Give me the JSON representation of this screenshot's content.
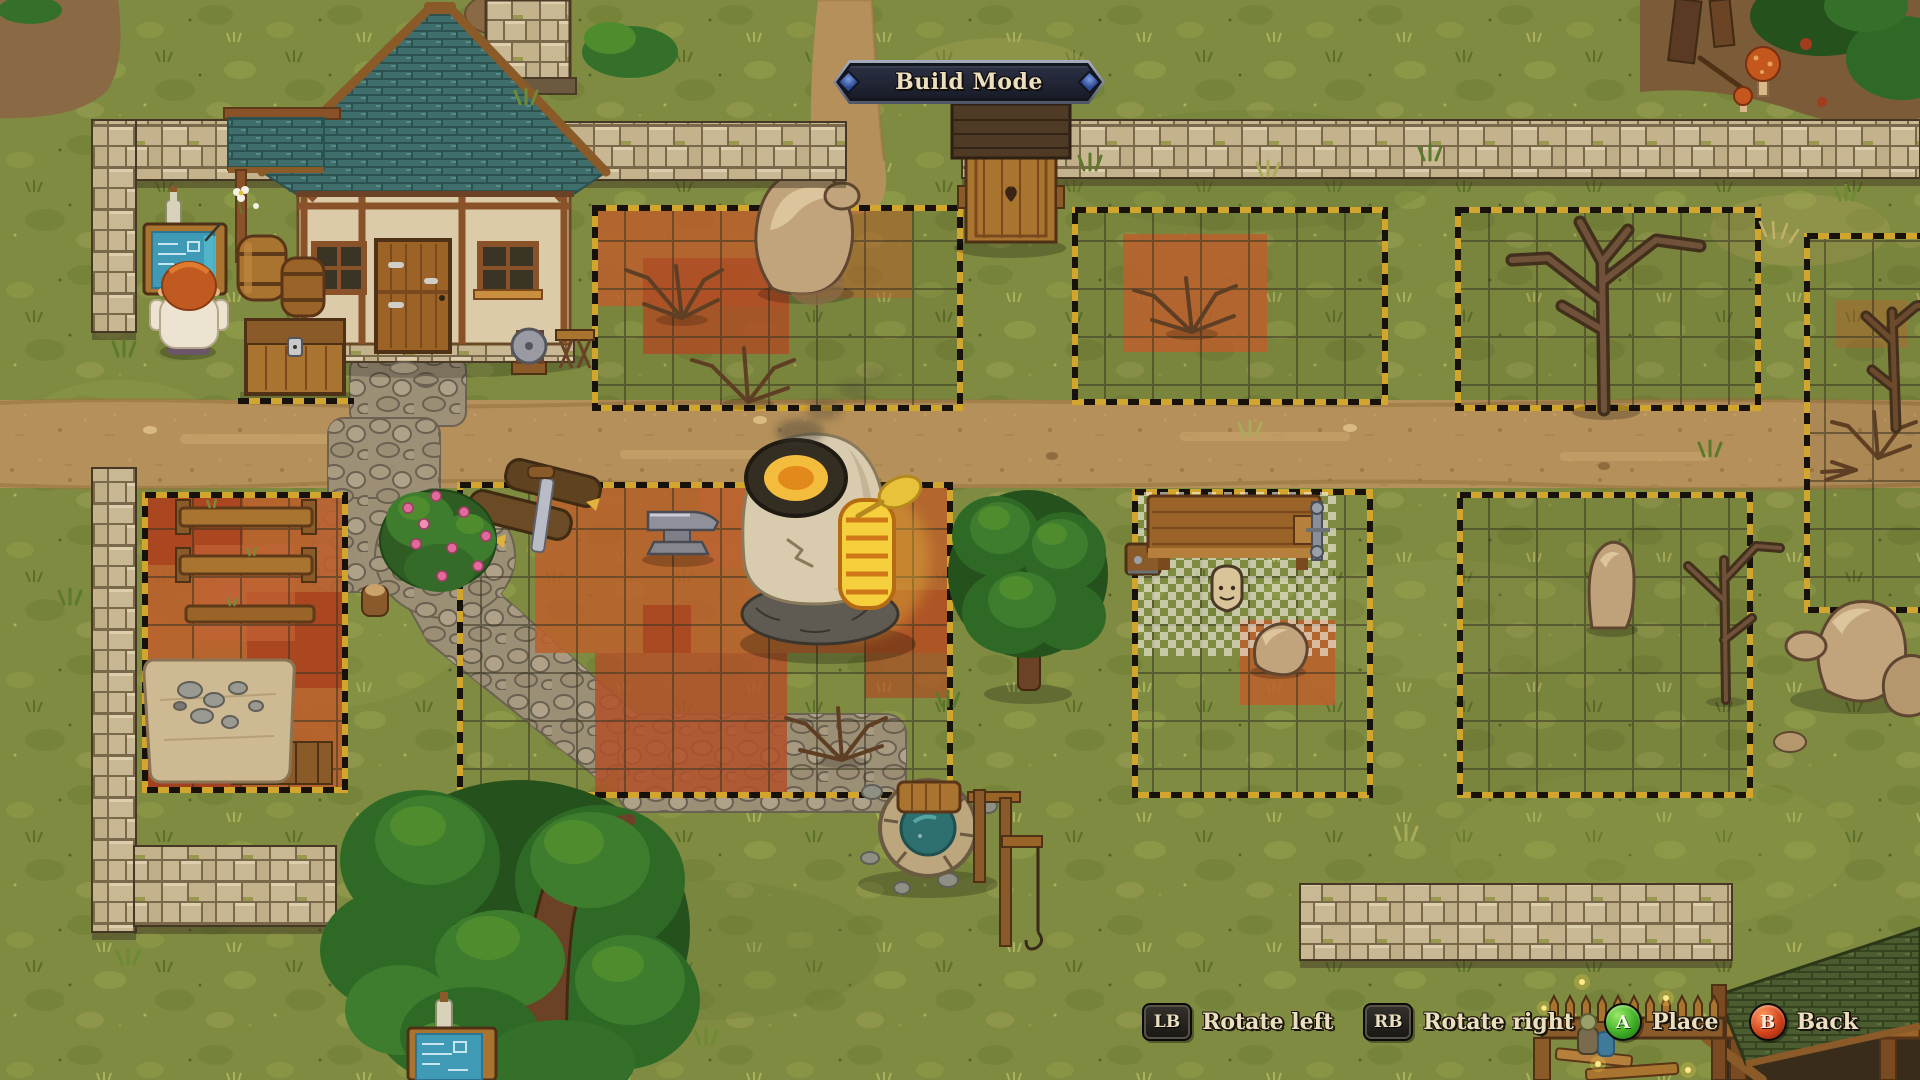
{
  "hud": {
    "mode_banner": {
      "label": "Build Mode"
    },
    "hint_bar": {
      "hints": [
        {
          "key": "LB",
          "shape": "keycap",
          "label": "Rotate left"
        },
        {
          "key": "RB",
          "shape": "keycap",
          "label": "Rotate right"
        },
        {
          "key": "A",
          "shape": "circle",
          "color": "#3fae26",
          "label": "Place"
        },
        {
          "key": "B",
          "shape": "circle",
          "color": "#d2431c",
          "label": "Back"
        }
      ]
    }
  },
  "palette": {
    "grass": "#7e8b41",
    "road": "#b5905a",
    "zone_tile": "#bc5f2c",
    "grid_line": "#3b3422",
    "hazard_yellow": "#d2a62c",
    "hazard_black": "#17130c",
    "wall_stone": "#c9b894",
    "roof_teal": "#3f6e6c",
    "wood": "#9a6428",
    "water_teal": "#2e6f6f",
    "glow_yellow": "#f6cf3d",
    "banner_face": "#2b3044",
    "banner_steel": "#8b93a5",
    "text_cream": "#ecdfc0",
    "btn_green": "#3fae26",
    "btn_red": "#d2431c"
  }
}
